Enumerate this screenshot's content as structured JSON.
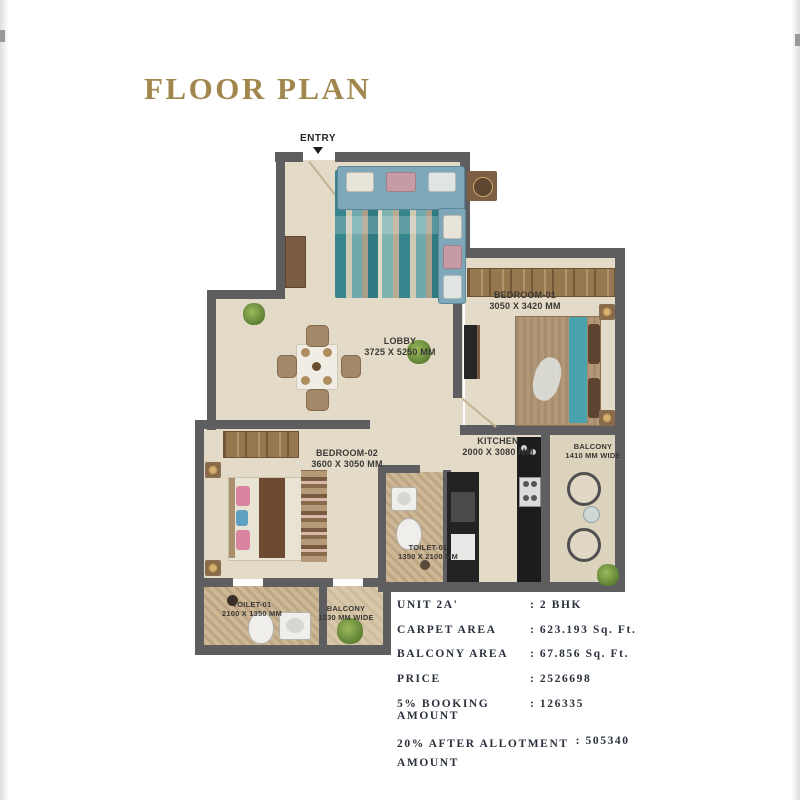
{
  "title": "FLOOR PLAN",
  "entry": {
    "label": "ENTRY"
  },
  "rooms": {
    "lobby": {
      "name": "LOBBY",
      "dim": "3725 X 5250 MM"
    },
    "bedroom1": {
      "name": "BEDROOM-01",
      "dim": "3050 X 3420 MM"
    },
    "bedroom2": {
      "name": "BEDROOM-02",
      "dim": "3600 X 3050 MM"
    },
    "kitchen": {
      "name": "KITCHEN",
      "dim": "2000 X 3080 MM"
    },
    "balcony_right": {
      "name": "BALCONY",
      "dim": "1410 MM WIDE"
    },
    "toilet_mid": {
      "name": "TOILET-01",
      "dim": "1350 X 2100 MM"
    },
    "toilet_bottom": {
      "name": "TOILET-01",
      "dim": "2100 X 1350 MM"
    },
    "balcony_bottom": {
      "name": "BALCONY",
      "dim": "1230 MM WIDE"
    }
  },
  "unit_details": {
    "rows": [
      {
        "label": "UNIT 2A'",
        "value": ": 2 BHK"
      },
      {
        "label": "CARPET AREA",
        "value": ": 623.193 Sq. Ft."
      },
      {
        "label": "BALCONY AREA",
        "value": ": 67.856 Sq. Ft."
      },
      {
        "label": "PRICE",
        "value": ": 2526698"
      },
      {
        "label": "5% BOOKING AMOUNT",
        "value": ": 126335"
      },
      {
        "label": "20% AFTER ALLOTMENT\nAMOUNT",
        "value": ": 505340"
      }
    ]
  },
  "colors": {
    "title_gold": "#a1874e",
    "wall_gray": "#5e5e60",
    "floor_beige": "#e3dbc7",
    "accent_teal": "#43969e",
    "details_text": "#2a313c"
  }
}
